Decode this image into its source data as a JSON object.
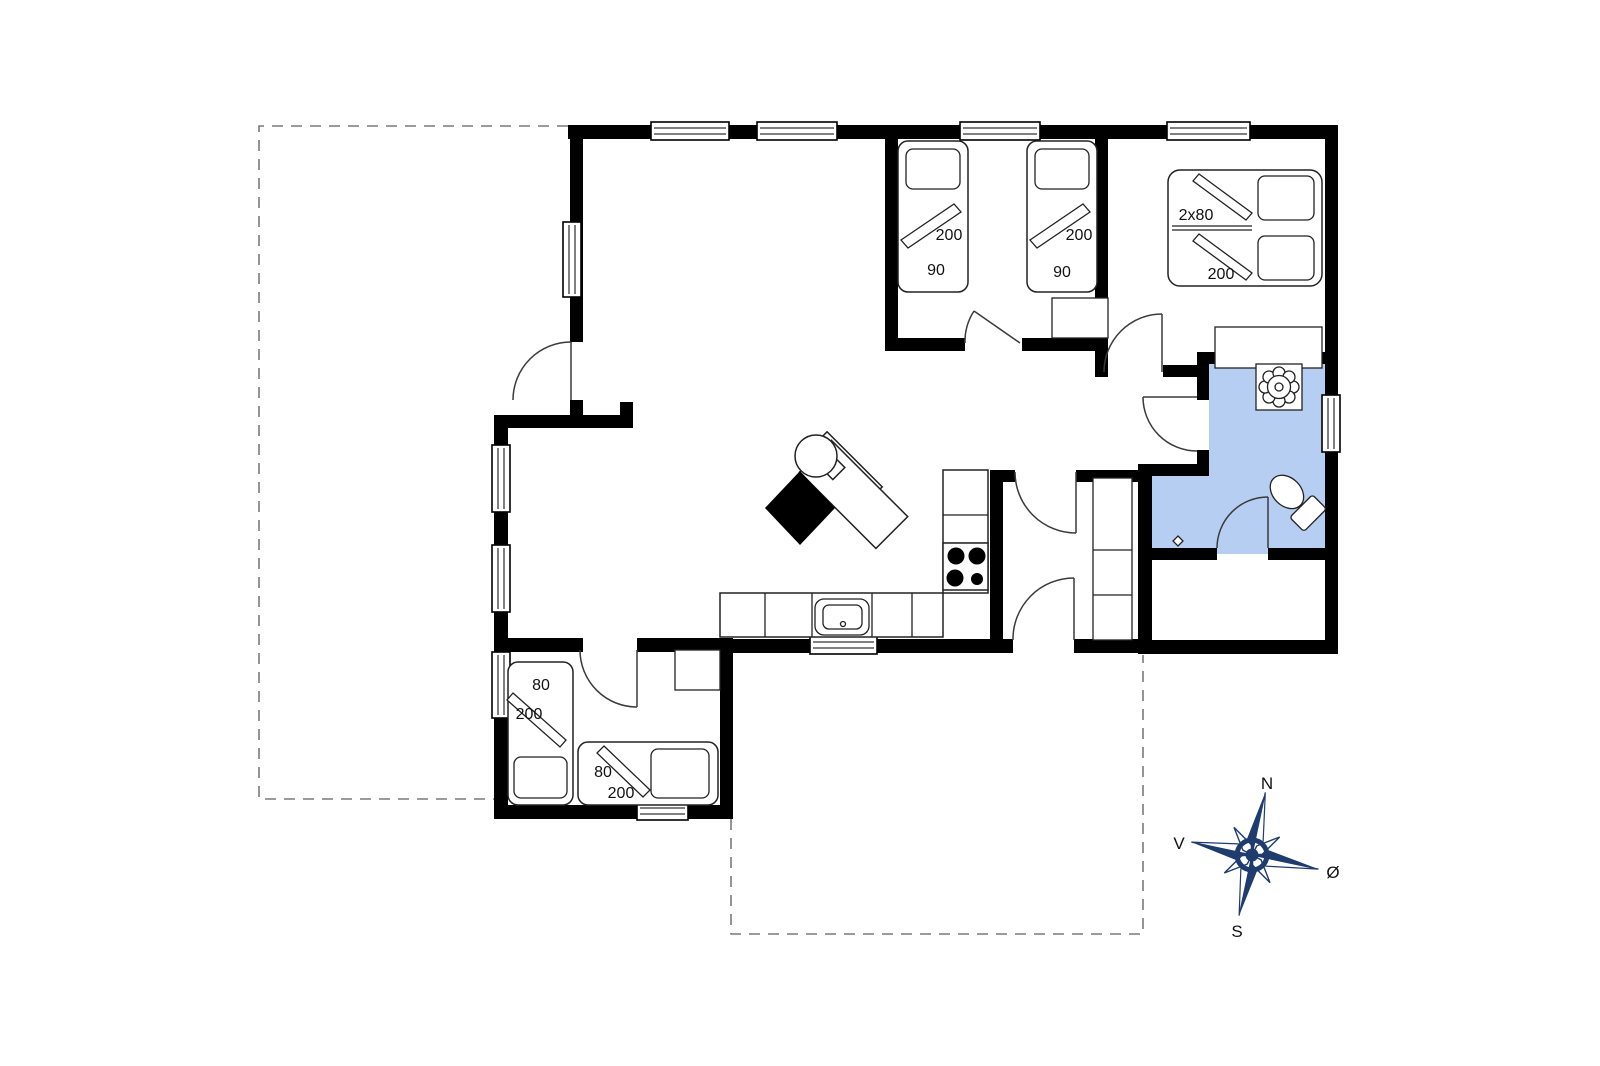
{
  "beds": {
    "twin_left": {
      "length": "200",
      "width": "90"
    },
    "twin_right": {
      "length": "200",
      "width": "90"
    },
    "double": {
      "size": "2x80",
      "length": "200"
    },
    "small_vertical": {
      "width": "80",
      "length": "200"
    },
    "small_horizontal": {
      "width": "80",
      "length": "200"
    }
  },
  "compass": {
    "north": "N",
    "south": "S",
    "west": "V",
    "east": "Ø"
  },
  "fixtures": [
    "wood-stove",
    "cooktop-burners",
    "kitchen-sink",
    "shower-drain",
    "toilet",
    "floor-drain"
  ],
  "colors": {
    "wall": "#000000",
    "bathroom_fill": "#b5cef2",
    "compass": "#1e3c6e",
    "dashed_line": "#7a7a7a"
  }
}
